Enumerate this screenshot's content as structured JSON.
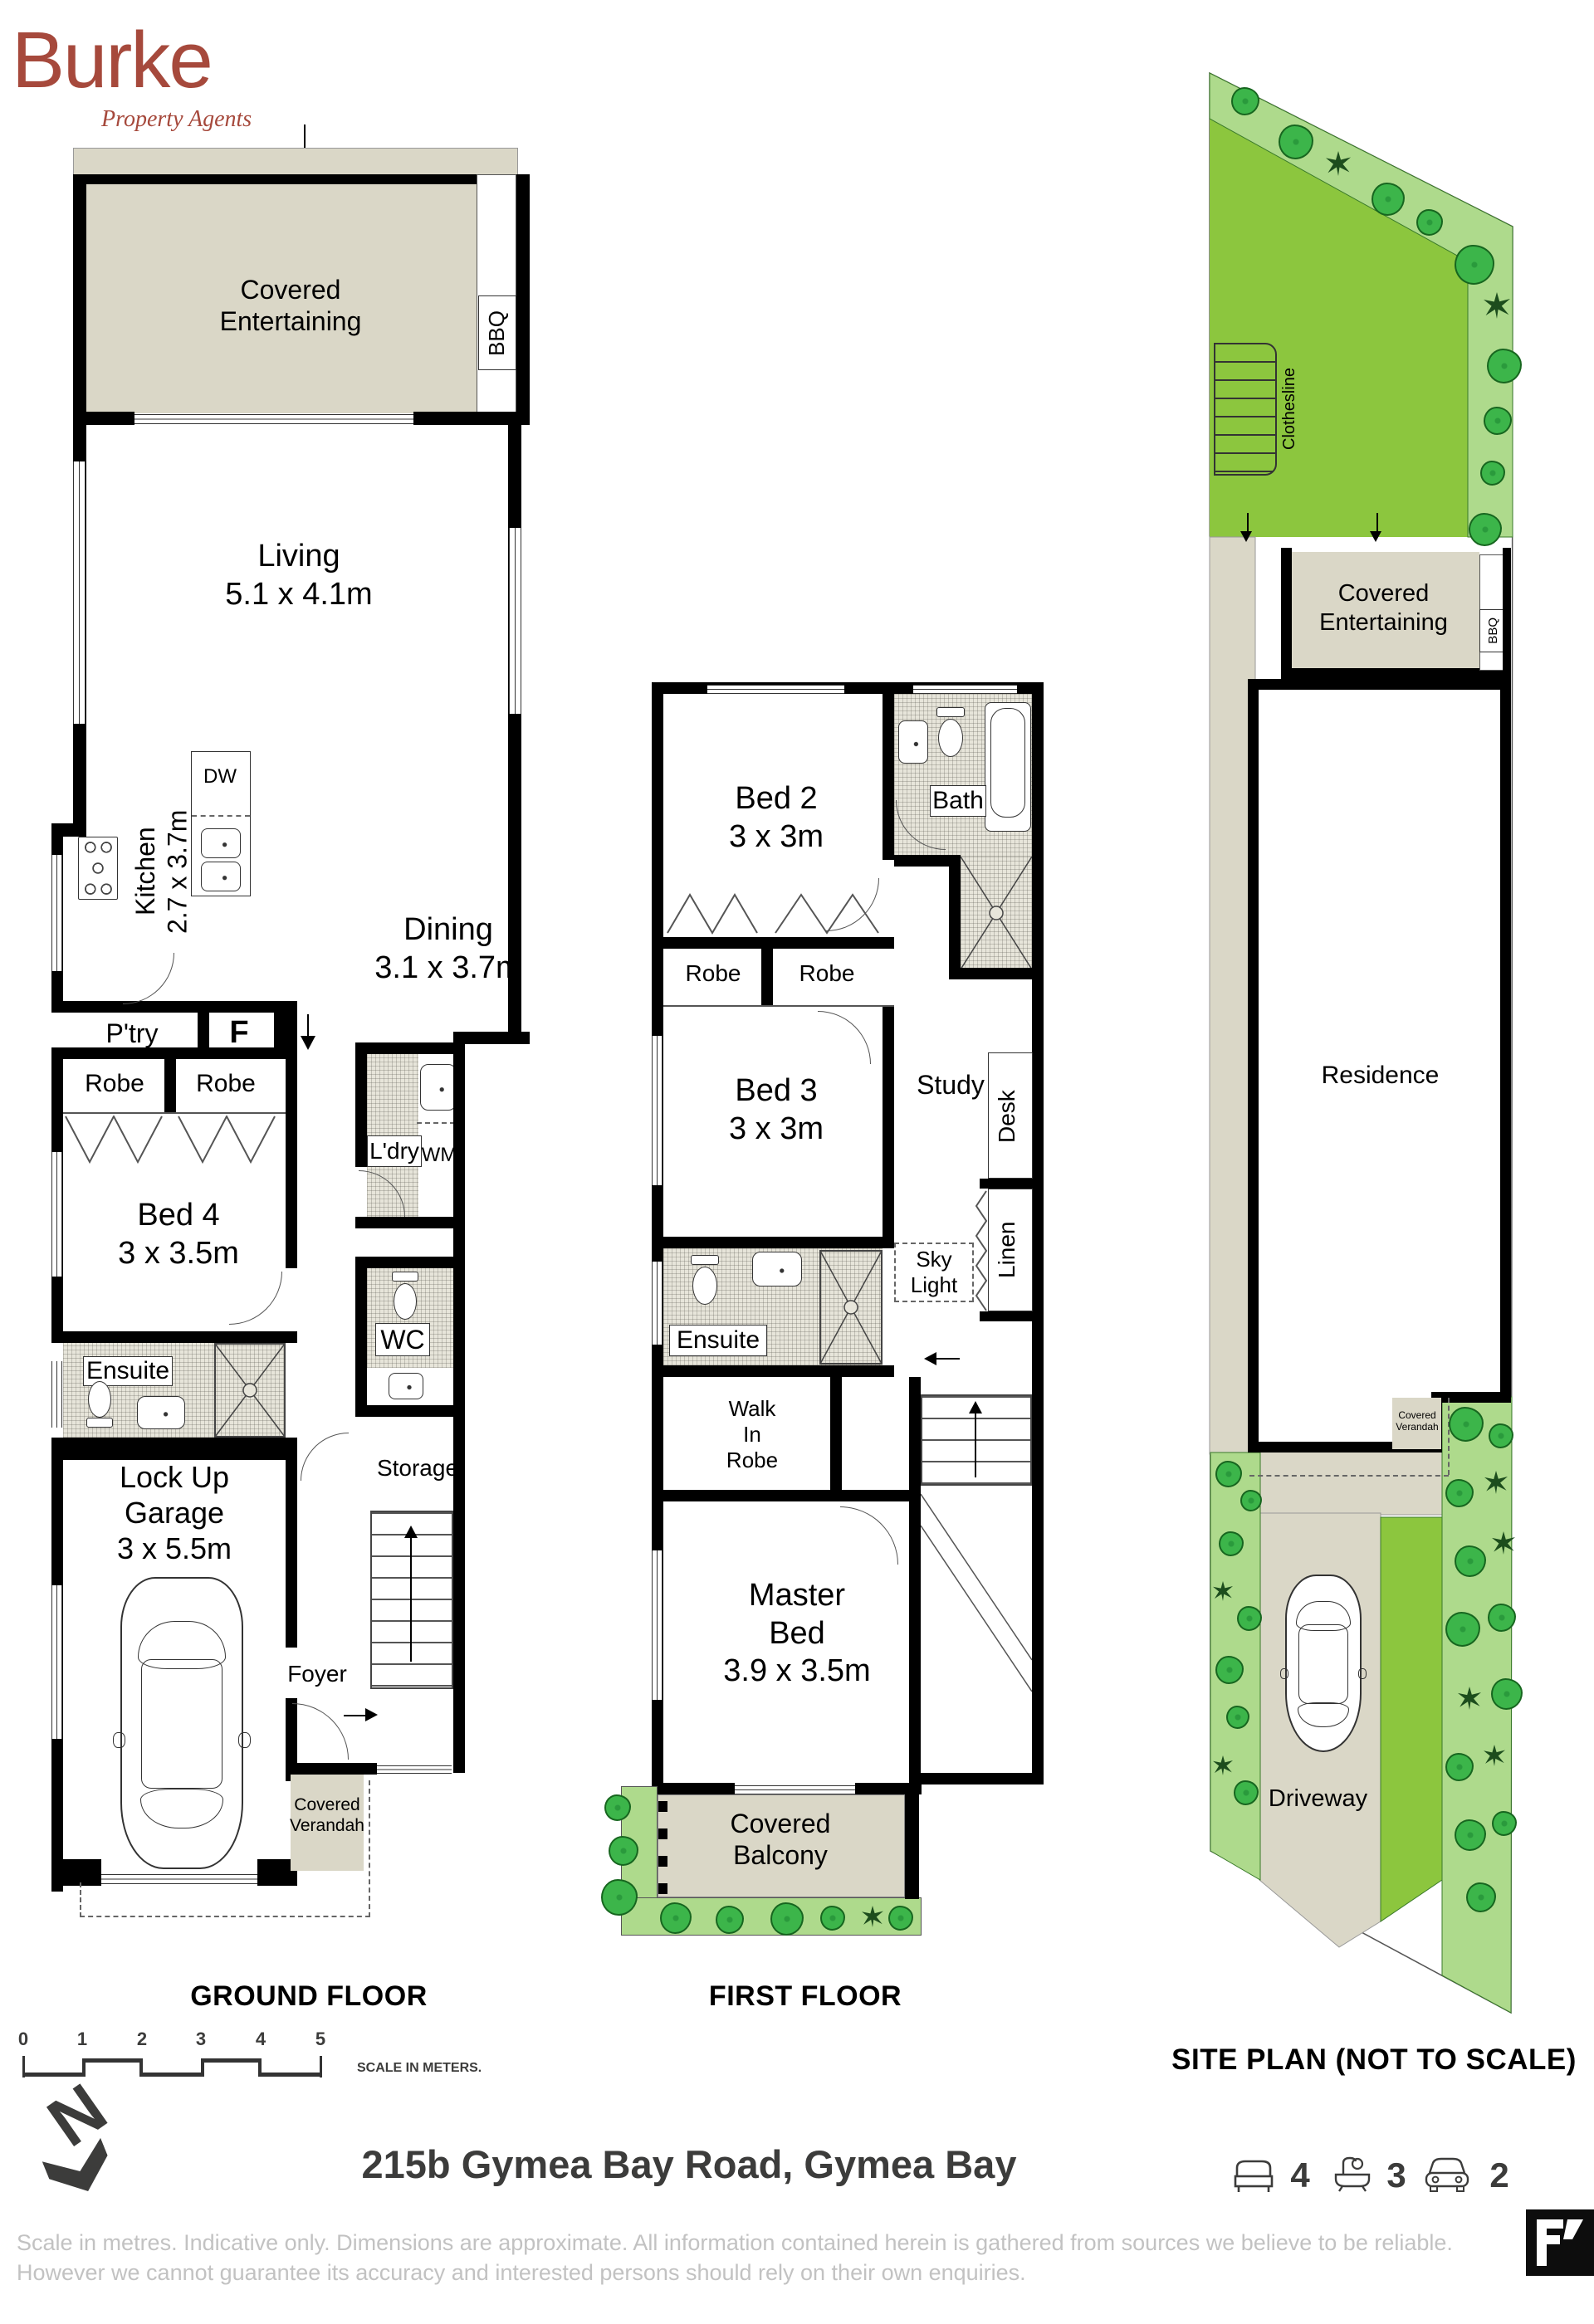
{
  "logo": {
    "name": "Burke",
    "tagline": "Property Agents"
  },
  "ground": {
    "title": "GROUND FLOOR",
    "covered_entertaining": "Covered\nEntertaining",
    "bbq": "BBQ",
    "living": "Living\n5.1 x 4.1m",
    "kitchen": "Kitchen\n2.7 x 3.7m",
    "dw": "DW",
    "dining": "Dining\n3.1 x 3.7m",
    "ptry": "P'try",
    "f": "F",
    "robe_left": "Robe",
    "robe_right": "Robe",
    "ldry": "L'dry",
    "wm": "WM",
    "bed4": "Bed 4\n3 x 3.5m",
    "ensuite": "Ensuite",
    "wc": "WC",
    "storage": "Storage",
    "garage": "Lock Up\nGarage\n3 x 5.5m",
    "foyer": "Foyer",
    "verandah": "Covered\nVerandah"
  },
  "first": {
    "title": "FIRST FLOOR",
    "bed2": "Bed 2\n3 x 3m",
    "bath": "Bath",
    "robe_left": "Robe",
    "robe_right": "Robe",
    "bed3": "Bed 3\n3 x 3m",
    "study": "Study",
    "desk": "Desk",
    "skylight": "Sky\nLight",
    "linen": "Linen",
    "ensuite": "Ensuite",
    "walk_in_robe": "Walk\nIn\nRobe",
    "master": "Master\nBed\n3.9 x 3.5m",
    "balcony": "Covered\nBalcony"
  },
  "site": {
    "title": "SITE PLAN (NOT TO SCALE)",
    "clothesline": "Clothesline",
    "covered_entertaining": "Covered\nEntertaining",
    "bbq": "BBQ",
    "ac": "A/C",
    "rwt": "RWT",
    "residence": "Residence",
    "verandah": "Covered\nVerandah",
    "driveway": "Driveway"
  },
  "footer": {
    "scale_ticks": [
      "0",
      "1",
      "2",
      "3",
      "4",
      "5"
    ],
    "scale_label": "SCALE IN METERS.",
    "north_letter": "N",
    "address": "215b Gymea Bay Road, Gymea Bay",
    "stats": {
      "beds": "4",
      "baths": "3",
      "cars": "2"
    },
    "icons": {
      "beds": "bed-icon",
      "baths": "bath-icon",
      "cars": "car-icon",
      "brand": "floorplan-logo-icon",
      "north": "north-arrow-icon"
    },
    "disclaimer_line1": "Scale in metres. Indicative only. Dimensions are approximate. All information contained herein is gathered from sources we believe to be reliable.",
    "disclaimer_line2": "However we cannot guarantee its accuracy and interested persons should rely on their own enquiries."
  },
  "colors": {
    "accent": "#A6493C",
    "covered_area": "#DAD7C7",
    "lawn": "#8CC63E",
    "garden": "#AEDA8C",
    "plant": "#3CB54A",
    "wall": "#000000",
    "text_dark": "#3C3C3B",
    "disclaimer": "#C2C2C2"
  }
}
